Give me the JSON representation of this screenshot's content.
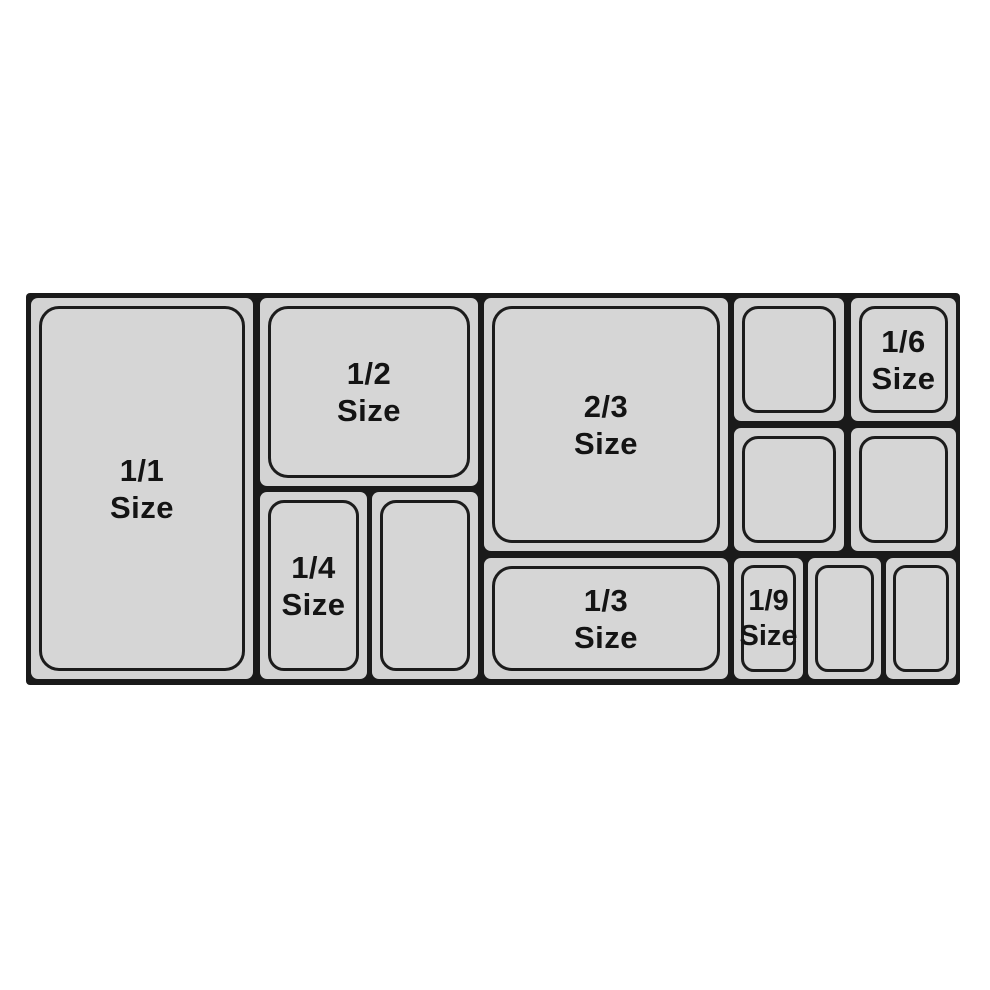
{
  "figure": {
    "kind": "gastronorm-pan-size-diagram",
    "colors": {
      "background": "#ffffff",
      "pan_fill": "#d3d3d3",
      "pan_inner_fill": "#d6d6d6",
      "line": "#1a1a1a",
      "text": "#141414"
    }
  },
  "pans": [
    {
      "id": "pan-1-1",
      "fraction": "1/1",
      "caption": "Size"
    },
    {
      "id": "pan-1-2",
      "fraction": "1/2",
      "caption": "Size"
    },
    {
      "id": "pan-1-4",
      "fraction": "1/4",
      "caption": "Size"
    },
    {
      "id": "pan-1-4-unlabeled",
      "fraction": "",
      "caption": ""
    },
    {
      "id": "pan-2-3",
      "fraction": "2/3",
      "caption": "Size"
    },
    {
      "id": "pan-1-3",
      "fraction": "1/3",
      "caption": "Size"
    },
    {
      "id": "pan-1-6-top-left",
      "fraction": "",
      "caption": ""
    },
    {
      "id": "pan-1-6-labeled",
      "fraction": "1/6",
      "caption": "Size"
    },
    {
      "id": "pan-1-6-bottom-left",
      "fraction": "",
      "caption": ""
    },
    {
      "id": "pan-1-6-bottom-right",
      "fraction": "",
      "caption": ""
    },
    {
      "id": "pan-1-9-labeled",
      "fraction": "1/9",
      "caption": "Size"
    },
    {
      "id": "pan-1-9-middle",
      "fraction": "",
      "caption": ""
    },
    {
      "id": "pan-1-9-right",
      "fraction": "",
      "caption": ""
    }
  ]
}
